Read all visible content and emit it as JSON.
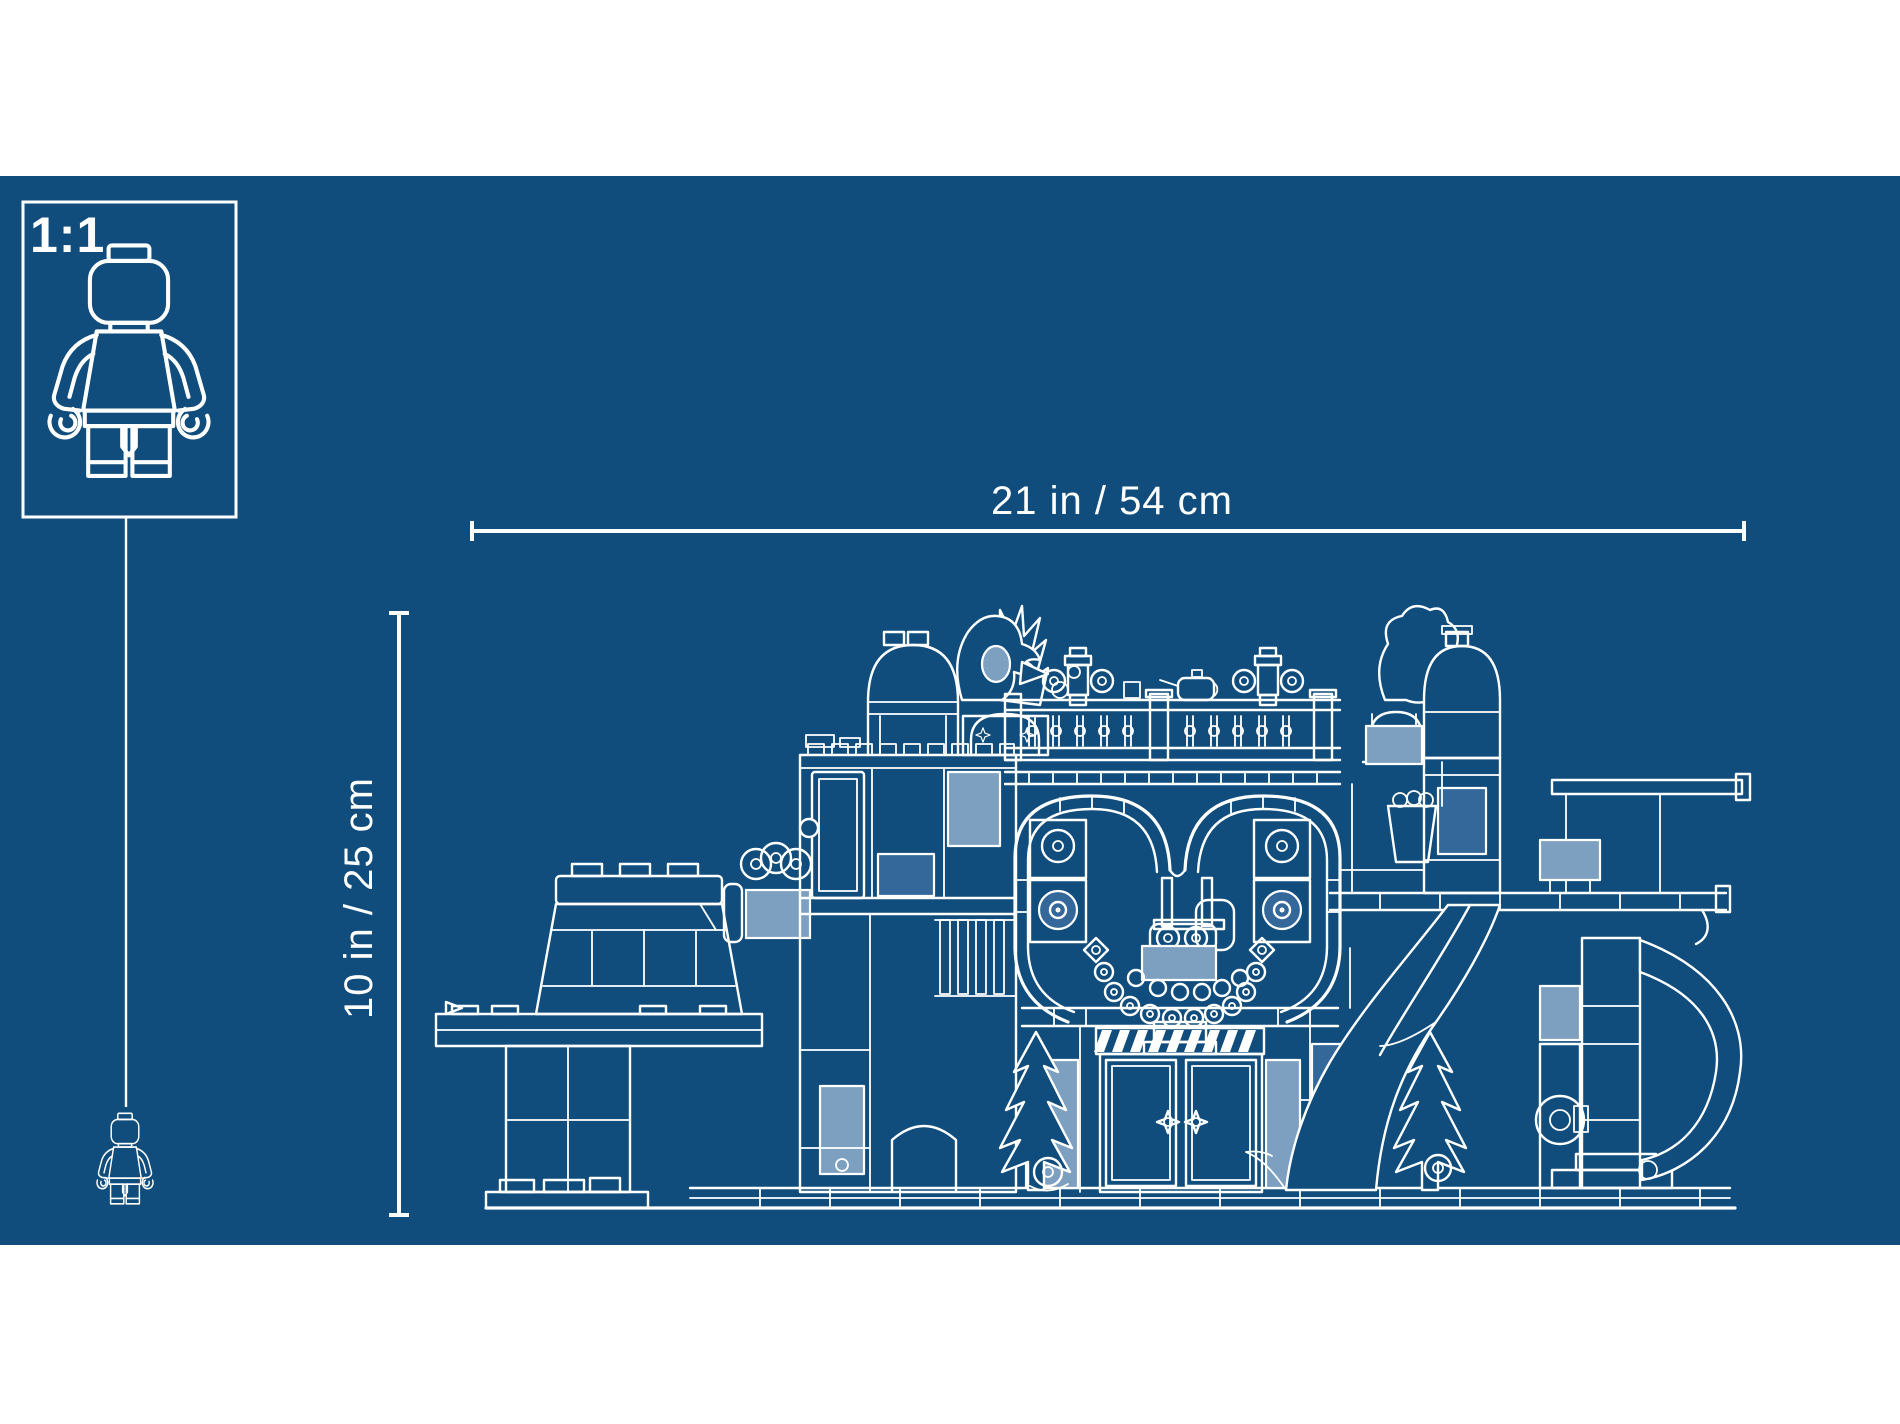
{
  "colors": {
    "page_bg": "#ffffff",
    "blueprint_bg": "#104d7c",
    "line": "#ffffff",
    "pane_light": "#7da0c1",
    "pane_mid": "#35689a"
  },
  "scale_box": {
    "label": "1:1",
    "icon": "minifigure-outline-icon"
  },
  "dimensions": {
    "width": {
      "label": "21 in / 54 cm"
    },
    "height": {
      "label": "10 in / 25 cm"
    }
  },
  "figures": {
    "large_minifigure_icon": "minifigure-outline-icon",
    "small_minifigure_icon": "minifigure-outline-icon",
    "artwork_icon": "lego-set-blueprint-line-art"
  }
}
